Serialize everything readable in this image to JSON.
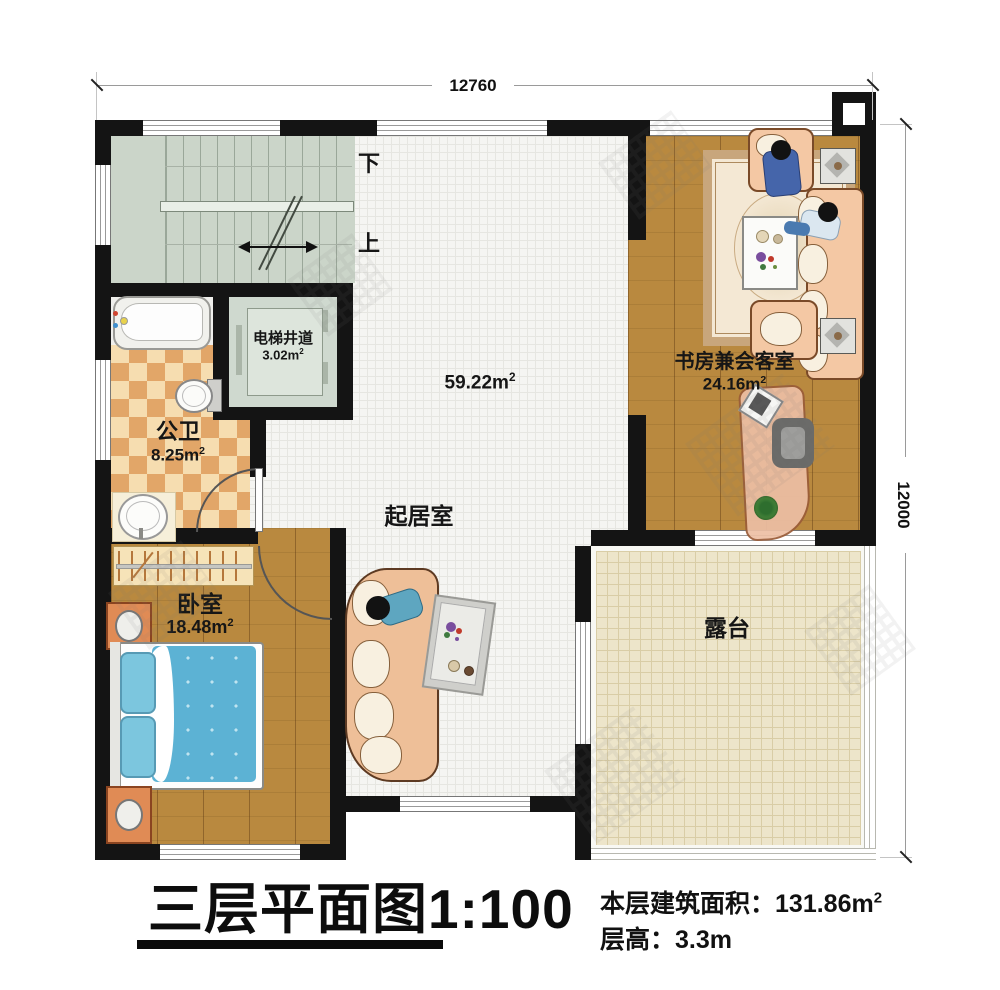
{
  "title_block": {
    "floor_title": "三层平面图",
    "scale": "1:100",
    "area_label": "本层建筑面积：",
    "area_value": "131.86m",
    "area_sup": "2",
    "height_text": "层高：3.3m"
  },
  "dimensions": {
    "top": "12760",
    "right": "12000"
  },
  "stairs": {
    "down": "下",
    "up": "上"
  },
  "rooms": {
    "living": {
      "name": "起居室",
      "area": "59.22m",
      "sup": "2"
    },
    "study": {
      "name": "书房兼会客室",
      "area": "24.16m",
      "sup": "2"
    },
    "bedroom": {
      "name": "卧室",
      "area": "18.48m",
      "sup": "2"
    },
    "bathroom": {
      "name": "公卫",
      "area": "8.25m",
      "sup": "2"
    },
    "elevator": {
      "name": "电梯井道",
      "area": "3.02m",
      "sup": "2"
    },
    "terrace": {
      "name": "露台"
    }
  },
  "colors": {
    "wall": "#141414",
    "wood_floor": "#b9893f",
    "stairs_floor": "#cbd5c9",
    "checker_light": "#f6ddb0",
    "checker_dark": "#e2a668",
    "terrace_floor": "#ede5ca",
    "bed_blanket": "#5cb2d4",
    "sofa": "#f2c8a4",
    "nightstand": "#e08b55"
  }
}
